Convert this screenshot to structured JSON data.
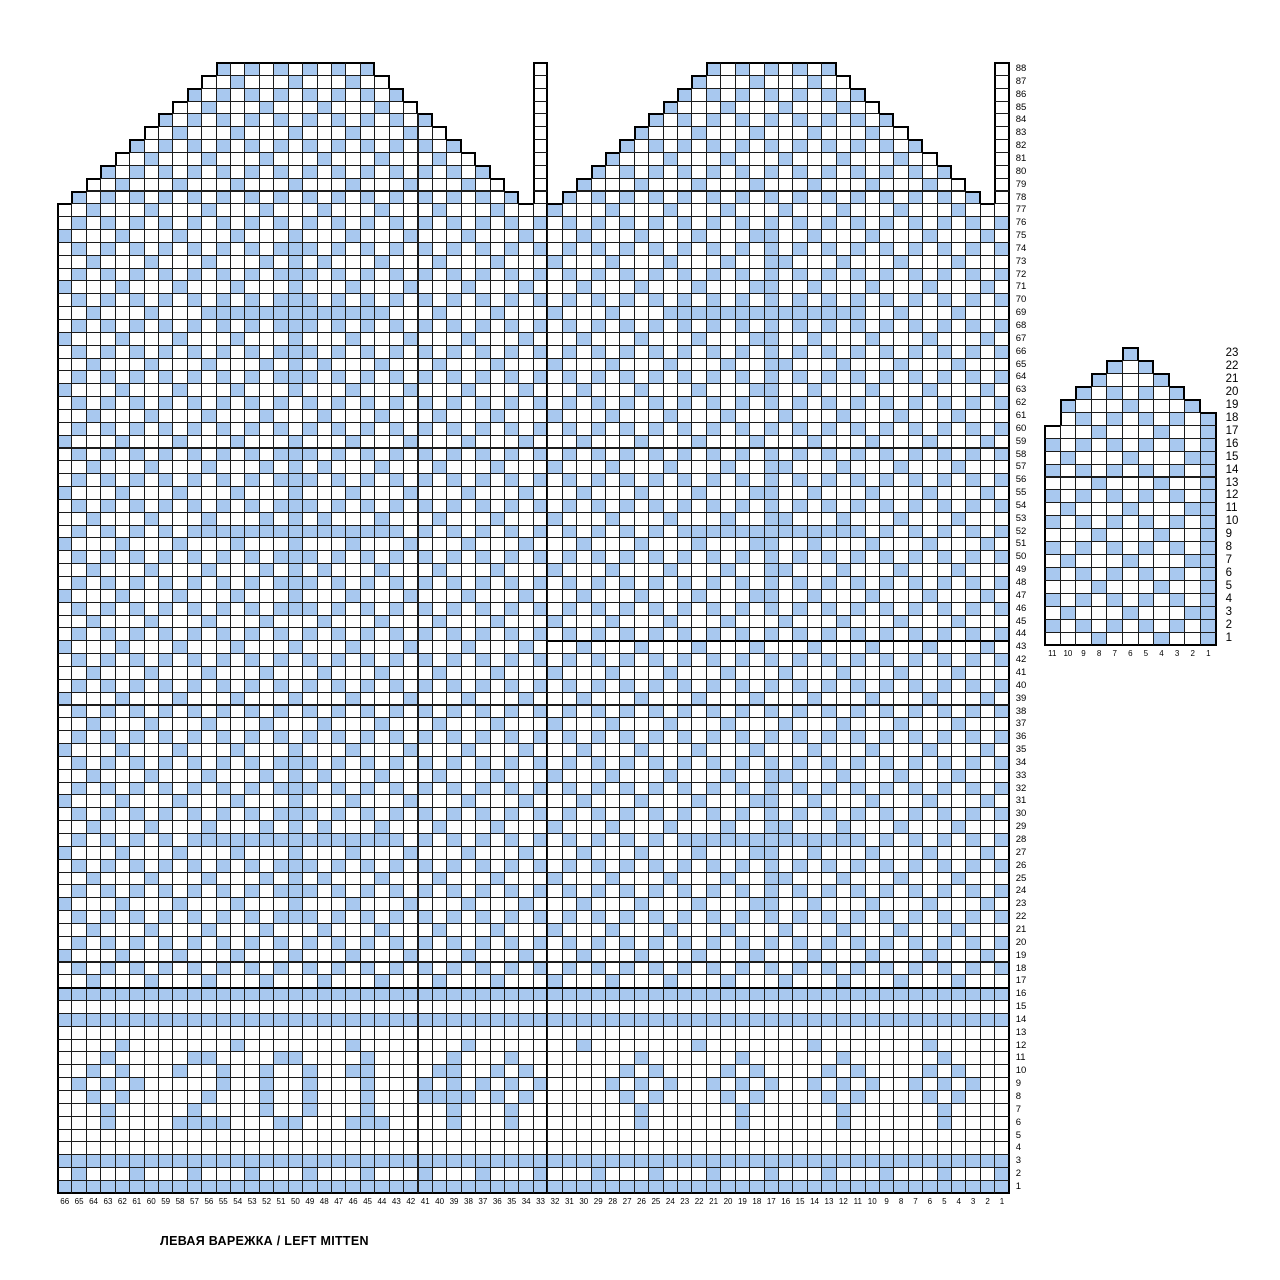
{
  "caption": "ЛЕВАЯ ВАРЕЖКА / LEFT MITTEN",
  "colors": {
    "stitch": "#a8c8ef",
    "no_stitch": "#ffffff",
    "grid_thin": "#1c1c1c",
    "grid_thick": "#000000"
  },
  "main_chart": {
    "title": "left mitten body chart, 66 stitches x 88 rounds",
    "cols": 66,
    "row_min": 1,
    "row_max": 88,
    "col_labels": [
      "66",
      "65",
      "64",
      "63",
      "62",
      "61",
      "60",
      "59",
      "58",
      "57",
      "56",
      "55",
      "54",
      "53",
      "52",
      "51",
      "50",
      "49",
      "48",
      "47",
      "46",
      "45",
      "44",
      "43",
      "42",
      "41",
      "40",
      "39",
      "38",
      "37",
      "36",
      "35",
      "34",
      "33",
      "32",
      "31",
      "30",
      "29",
      "28",
      "27",
      "26",
      "25",
      "24",
      "23",
      "22",
      "21",
      "20",
      "19",
      "18",
      "17",
      "16",
      "15",
      "14",
      "13",
      "12",
      "11",
      "10",
      "9",
      "8",
      "7",
      "6",
      "5",
      "4",
      "3",
      "2",
      "1"
    ],
    "seam_cols": [
      33,
      65
    ],
    "seam_white_from": 77,
    "thick_right_cols": [
      33
    ],
    "thick_row_tops": [
      {
        "row": 16,
        "from": 0,
        "to": 65
      },
      {
        "row": 43,
        "from": 34,
        "to": 65
      }
    ],
    "tip_ranges": {
      "78": [
        [
          1,
          31
        ],
        [
          35,
          63
        ]
      ],
      "79": [
        [
          2,
          30
        ],
        [
          36,
          62
        ]
      ],
      "80": [
        [
          3,
          29
        ],
        [
          37,
          61
        ]
      ],
      "81": [
        [
          4,
          28
        ],
        [
          38,
          60
        ]
      ],
      "82": [
        [
          5,
          27
        ],
        [
          39,
          59
        ]
      ],
      "83": [
        [
          6,
          26
        ],
        [
          40,
          58
        ]
      ],
      "84": [
        [
          7,
          25
        ],
        [
          41,
          57
        ]
      ],
      "85": [
        [
          8,
          24
        ],
        [
          42,
          56
        ]
      ],
      "86": [
        [
          9,
          23
        ],
        [
          43,
          55
        ]
      ],
      "87": [
        [
          10,
          22
        ],
        [
          44,
          54
        ]
      ],
      "88": [
        [
          11,
          21
        ],
        [
          45,
          53
        ]
      ]
    },
    "patterns": {
      "A": [
        [
          "..X.",
          16
        ],
        [
          ".."
        ]
      ],
      "B": [
        [
          ".X.X",
          16
        ],
        [
          ".X"
        ]
      ],
      "C": [
        [
          "X...",
          16
        ],
        [
          "X."
        ]
      ],
      "A1": [
        [
          "..X.",
          4
        ],
        [
          "X.X."
        ],
        [
          "..X.",
          7
        ],
        [
          ".XX."
        ],
        [
          "..X.",
          3
        ],
        [
          ".."
        ]
      ],
      "B1": [
        [
          ".X.X",
          4
        ],
        [
          "XX.X"
        ],
        [
          ".X.X",
          11
        ],
        [
          ".X"
        ]
      ],
      "C1": [
        [
          "X...",
          12
        ],
        [
          "XX.."
        ],
        [
          "X...",
          3
        ],
        [
          "X."
        ]
      ],
      "HB": [
        [
          ".X.X.X.X.X"
        ],
        [
          "X",
          13
        ],
        [
          "X.X.X.X.X.X.X.X.X.X."
        ],
        [
          "X",
          13
        ],
        [
          ".X.X.X.X.X"
        ]
      ],
      "HA": [
        [
          "..X...X..."
        ],
        [
          "X",
          13
        ],
        [
          "...X...X...X...X...X"
        ],
        [
          "X",
          13
        ],
        [
          "..X...X..."
        ]
      ],
      "FULL": [
        [
          "X",
          66
        ]
      ],
      "EMPTY": [
        [
          ".",
          66
        ]
      ],
      "R12": [
        [
          "....X...",
          8
        ],
        [
          ".."
        ]
      ],
      "R11": [
        [
          "."
        ],
        [
          "..X.."
        ],
        [
          ".."
        ],
        [
          ".XX."
        ],
        [
          ".."
        ],
        [
          ".XX."
        ],
        [
          ".."
        ],
        [
          ".X."
        ],
        [
          ".."
        ],
        [
          "..X."
        ],
        [
          "..X.."
        ],
        [
          "...."
        ],
        [
          "..X.."
        ],
        [
          ".."
        ],
        [
          "..X.."
        ],
        [
          ".."
        ],
        [
          "..X.."
        ],
        [
          ".."
        ],
        [
          "..X.."
        ],
        [
          ".."
        ]
      ],
      "R10": [
        [
          "."
        ],
        [
          ".X.X."
        ],
        [
          ".."
        ],
        [
          "X..X"
        ],
        [
          ".."
        ],
        [
          "X..X"
        ],
        [
          ".."
        ],
        [
          "XX."
        ],
        [
          ".."
        ],
        [
          ".XX."
        ],
        [
          ".X.X."
        ],
        [
          "...."
        ],
        [
          ".X.X."
        ],
        [
          ".."
        ],
        [
          ".X.X."
        ],
        [
          ".."
        ],
        [
          ".X.X."
        ],
        [
          ".."
        ],
        [
          ".X.X."
        ],
        [
          ".."
        ]
      ],
      "R9": [
        [
          "."
        ],
        [
          "X.X.X"
        ],
        [
          ".."
        ],
        [
          "...X"
        ],
        [
          ".."
        ],
        [
          "X..X"
        ],
        [
          ".."
        ],
        [
          ".X."
        ],
        [
          ".."
        ],
        [
          "X.X."
        ],
        [
          "X.X.X"
        ],
        [
          "...."
        ],
        [
          "X.X.X"
        ],
        [
          ".."
        ],
        [
          "X.X.X"
        ],
        [
          ".."
        ],
        [
          "X.X.X"
        ],
        [
          ".."
        ],
        [
          "X.X.X"
        ],
        [
          ".."
        ]
      ],
      "R8": [
        [
          "."
        ],
        [
          ".X.X."
        ],
        [
          ".."
        ],
        [
          "..X."
        ],
        [
          ".."
        ],
        [
          "X..X"
        ],
        [
          ".."
        ],
        [
          ".X."
        ],
        [
          ".."
        ],
        [
          "XXXX"
        ],
        [
          ".X.X."
        ],
        [
          "...."
        ],
        [
          ".X.X."
        ],
        [
          ".."
        ],
        [
          ".X.X."
        ],
        [
          ".."
        ],
        [
          ".X.X."
        ],
        [
          ".."
        ],
        [
          ".X.X."
        ],
        [
          ".."
        ]
      ],
      "R7": [
        [
          "."
        ],
        [
          "..X.."
        ],
        [
          ".."
        ],
        [
          ".X.."
        ],
        [
          ".."
        ],
        [
          "X..X"
        ],
        [
          ".."
        ],
        [
          ".X."
        ],
        [
          ".."
        ],
        [
          "..X."
        ],
        [
          "..X.."
        ],
        [
          "...."
        ],
        [
          "..X.."
        ],
        [
          ".."
        ],
        [
          "..X.."
        ],
        [
          ".."
        ],
        [
          "..X.."
        ],
        [
          ".."
        ],
        [
          "..X.."
        ],
        [
          ".."
        ]
      ],
      "R6": [
        [
          "."
        ],
        [
          "..X.."
        ],
        [
          ".."
        ],
        [
          "XXXX"
        ],
        [
          ".."
        ],
        [
          ".XX."
        ],
        [
          ".."
        ],
        [
          "XXX"
        ],
        [
          ".."
        ],
        [
          "..X."
        ],
        [
          "..X.."
        ],
        [
          "...."
        ],
        [
          "..X.."
        ],
        [
          ".."
        ],
        [
          "..X.."
        ],
        [
          ".."
        ],
        [
          "..X.."
        ],
        [
          ".."
        ],
        [
          "..X.."
        ],
        [
          ".."
        ]
      ],
      "R2": [
        [
          ".X..",
          16
        ],
        [
          ".X"
        ]
      ]
    },
    "rows": [
      {
        "n": 88,
        "pat": "B"
      },
      {
        "n": 87,
        "pat": "C"
      },
      {
        "n": 86,
        "pat": "B"
      },
      {
        "n": 85,
        "pat": "A"
      },
      {
        "n": 84,
        "pat": "B"
      },
      {
        "n": 83,
        "pat": "C"
      },
      {
        "n": 82,
        "pat": "B"
      },
      {
        "n": 81,
        "pat": "A"
      },
      {
        "n": 80,
        "pat": "B"
      },
      {
        "n": 79,
        "pat": "C"
      },
      {
        "n": 78,
        "pat": "B"
      },
      {
        "n": 77,
        "pat": "A"
      },
      {
        "n": 76,
        "pat": "B"
      },
      {
        "n": 75,
        "pat": "C1"
      },
      {
        "n": 74,
        "pat": "B1"
      },
      {
        "n": 73,
        "pat": "A1"
      },
      {
        "n": 72,
        "pat": "B1"
      },
      {
        "n": 71,
        "pat": "C1"
      },
      {
        "n": 70,
        "pat": "B1"
      },
      {
        "n": 69,
        "pat": "HA"
      },
      {
        "n": 68,
        "pat": "B1"
      },
      {
        "n": 67,
        "pat": "C1"
      },
      {
        "n": 66,
        "pat": "B1"
      },
      {
        "n": 65,
        "pat": "A1"
      },
      {
        "n": 64,
        "pat": "B1"
      },
      {
        "n": 63,
        "pat": "C1"
      },
      {
        "n": 62,
        "pat": "B"
      },
      {
        "n": 61,
        "pat": "A"
      },
      {
        "n": 60,
        "pat": "B"
      },
      {
        "n": 59,
        "pat": "C"
      },
      {
        "n": 58,
        "pat": "B1"
      },
      {
        "n": 57,
        "pat": "A1"
      },
      {
        "n": 56,
        "pat": "B1"
      },
      {
        "n": 55,
        "pat": "C1"
      },
      {
        "n": 54,
        "pat": "B1"
      },
      {
        "n": 53,
        "pat": "A1"
      },
      {
        "n": 52,
        "pat": "HB"
      },
      {
        "n": 51,
        "pat": "C1"
      },
      {
        "n": 50,
        "pat": "B1"
      },
      {
        "n": 49,
        "pat": "A1"
      },
      {
        "n": 48,
        "pat": "B1"
      },
      {
        "n": 47,
        "pat": "C1"
      },
      {
        "n": 46,
        "pat": "B1"
      },
      {
        "n": 45,
        "pat": "A"
      },
      {
        "n": 44,
        "pat": "B"
      },
      {
        "n": 43,
        "pat": "C"
      },
      {
        "n": 42,
        "pat": "B"
      },
      {
        "n": 41,
        "pat": "A"
      },
      {
        "n": 40,
        "pat": "B"
      },
      {
        "n": 39,
        "pat": "C"
      },
      {
        "n": 38,
        "pat": "B"
      },
      {
        "n": 37,
        "pat": "A"
      },
      {
        "n": 36,
        "pat": "B"
      },
      {
        "n": 35,
        "pat": "C"
      },
      {
        "n": 34,
        "pat": "B1"
      },
      {
        "n": 33,
        "pat": "A1"
      },
      {
        "n": 32,
        "pat": "B1"
      },
      {
        "n": 31,
        "pat": "C1"
      },
      {
        "n": 30,
        "pat": "B1"
      },
      {
        "n": 29,
        "pat": "A1"
      },
      {
        "n": 28,
        "pat": "HB"
      },
      {
        "n": 27,
        "pat": "C1"
      },
      {
        "n": 26,
        "pat": "B1"
      },
      {
        "n": 25,
        "pat": "A1"
      },
      {
        "n": 24,
        "pat": "B1"
      },
      {
        "n": 23,
        "pat": "C1"
      },
      {
        "n": 22,
        "pat": "B1"
      },
      {
        "n": 21,
        "pat": "A"
      },
      {
        "n": 20,
        "pat": "B"
      },
      {
        "n": 19,
        "pat": "C"
      },
      {
        "n": 18,
        "pat": "B"
      },
      {
        "n": 17,
        "pat": "A"
      },
      {
        "n": 16,
        "pat": "FULL"
      },
      {
        "n": 15,
        "pat": "EMPTY"
      },
      {
        "n": 14,
        "pat": "FULL"
      },
      {
        "n": 13,
        "pat": "EMPTY"
      },
      {
        "n": 12,
        "pat": "R12"
      },
      {
        "n": 11,
        "pat": "R11"
      },
      {
        "n": 10,
        "pat": "R10"
      },
      {
        "n": 9,
        "pat": "R9"
      },
      {
        "n": 8,
        "pat": "R8"
      },
      {
        "n": 7,
        "pat": "R7"
      },
      {
        "n": 6,
        "pat": "R6"
      },
      {
        "n": 5,
        "pat": "EMPTY"
      },
      {
        "n": 4,
        "pat": "EMPTY"
      },
      {
        "n": 3,
        "pat": "FULL"
      },
      {
        "n": 2,
        "pat": "R2"
      },
      {
        "n": 1,
        "pat": "FULL"
      }
    ]
  },
  "thumb_chart": {
    "title": "thumb chart, 11 stitches x 23 rounds",
    "cols": 11,
    "row_min": 1,
    "row_max": 23,
    "col_labels": [
      "11",
      "10",
      "9",
      "8",
      "7",
      "6",
      "5",
      "4",
      "3",
      "2",
      "1"
    ],
    "tip_ranges": {
      "18": [
        [
          1,
          10
        ]
      ],
      "19": [
        [
          1,
          9
        ]
      ],
      "20": [
        [
          2,
          8
        ]
      ],
      "21": [
        [
          3,
          7
        ]
      ],
      "22": [
        [
          4,
          6
        ]
      ],
      "23": [
        [
          5,
          5
        ]
      ]
    },
    "patterns": {
      "TA": [
        [
          "...X...X..."
        ]
      ],
      "TAe": [
        [
          "...X...X..X"
        ]
      ],
      "TB": [
        [
          "X.X.X.X.X.X"
        ]
      ],
      "TC": [
        [
          ".X...X...X."
        ]
      ],
      "TCe": [
        [
          ".X...X...XX"
        ]
      ]
    },
    "rows": [
      {
        "n": 23,
        "pat": "TC"
      },
      {
        "n": 22,
        "pat": "TB"
      },
      {
        "n": 21,
        "pat": "TA"
      },
      {
        "n": 20,
        "pat": "TB"
      },
      {
        "n": 19,
        "pat": "TC"
      },
      {
        "n": 18,
        "pat": "TB"
      },
      {
        "n": 17,
        "pat": "TAe"
      },
      {
        "n": 16,
        "pat": "TB"
      },
      {
        "n": 15,
        "pat": "TCe"
      },
      {
        "n": 14,
        "pat": "TB"
      },
      {
        "n": 13,
        "pat": "TAe"
      },
      {
        "n": 12,
        "pat": "TB"
      },
      {
        "n": 11,
        "pat": "TCe"
      },
      {
        "n": 10,
        "pat": "TB"
      },
      {
        "n": 9,
        "pat": "TAe"
      },
      {
        "n": 8,
        "pat": "TB"
      },
      {
        "n": 7,
        "pat": "TCe"
      },
      {
        "n": 6,
        "pat": "TB"
      },
      {
        "n": 5,
        "pat": "TAe"
      },
      {
        "n": 4,
        "pat": "TB"
      },
      {
        "n": 3,
        "pat": "TCe"
      },
      {
        "n": 2,
        "pat": "TB"
      },
      {
        "n": 1,
        "pat": "TAe"
      }
    ]
  }
}
